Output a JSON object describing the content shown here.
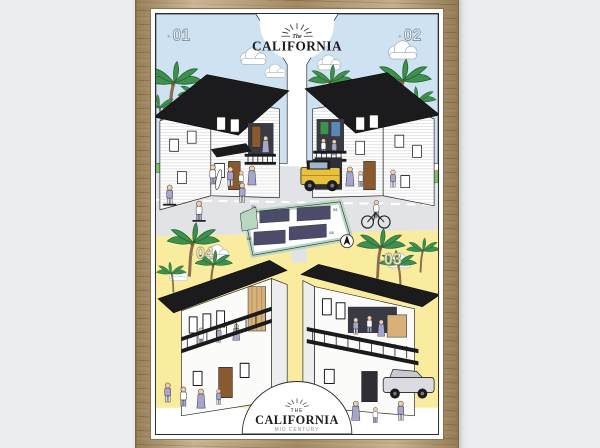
{
  "scene": {
    "description": "Framed illustrated poster of four California houses",
    "top_logo": {
      "prefix": "The",
      "title": "CALIFORNIA"
    },
    "bottom_logo": {
      "prefix": "THE",
      "title": "CALIFORNIA",
      "subtitle": "MID CENTURY"
    },
    "units": [
      {
        "marker": "✳",
        "label": "01",
        "style": "traditional clapboard house"
      },
      {
        "marker": "✳",
        "label": "02",
        "style": "traditional clapboard house"
      },
      {
        "marker": "✳",
        "label": "03",
        "style": "mid century modern house"
      },
      {
        "marker": "✳",
        "label": "04",
        "style": "mid century modern house"
      }
    ],
    "site_plan": {
      "lots": [
        "01",
        "02",
        "03",
        "04"
      ]
    },
    "colors": {
      "background_gray": "#ecedef",
      "frame_wood": "#b49a71",
      "sky_blue": "#cfe2f1",
      "sand_yellow": "#f9ec9e",
      "street_gray": "#e2e3e6",
      "roof_black": "#1b1b1e",
      "plan_mint": "#b7d7c3",
      "footprint_navy": "#4c4c6a",
      "clothes_lavender": "#a5a5cd",
      "jeep_yellow": "#e8c23c",
      "palm_green": "#3f8f4f",
      "door_wood": "#8a5a2f"
    }
  }
}
